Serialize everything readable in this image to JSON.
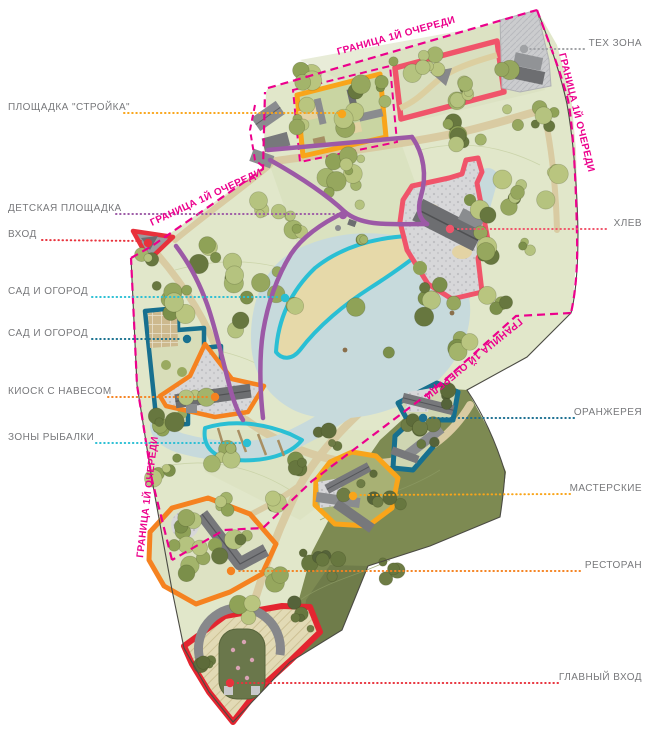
{
  "plan": {
    "boundary_label": "ГРАНИЦА 1Й ОЧЕРЕДИ",
    "left_labels": [
      {
        "text": "ПЛОЩАДКА \"СТРОЙКА\"",
        "color": "#F9A51A"
      },
      {
        "text": "ДЕТСКАЯ ПЛОЩАДКА",
        "color": "#9C59A6"
      },
      {
        "text": "ВХОД",
        "color": "#E8323C"
      },
      {
        "text": "САД И ОГОРОД",
        "color": "#2ABFD4"
      },
      {
        "text": "САД И ОГОРОД",
        "color": "#17708F"
      },
      {
        "text": "КИОСК С НАВЕСОМ",
        "color": "#F58220"
      },
      {
        "text": "ЗОНЫ РЫБАЛКИ",
        "color": "#2ABFD4"
      }
    ],
    "right_labels": [
      {
        "text": "ТЕХ ЗОНА",
        "color": "#A0A2A5"
      },
      {
        "text": "ХЛЕВ",
        "color": "#F0546A"
      },
      {
        "text": "ОРАНЖЕРЕЯ",
        "color": "#1B6F91"
      },
      {
        "text": "МАСТЕРСКИЕ",
        "color": "#F9A51A"
      },
      {
        "text": "РЕСТОРАН",
        "color": "#F58220"
      },
      {
        "text": "ГЛАВНЫЙ ВХОД",
        "color": "#E8323C"
      }
    ],
    "colors": {
      "phase_boundary_magenta": "#EC008C",
      "path_purple": "#9C59A6",
      "water": "#C7DADC",
      "park_green": "#E1E7CA",
      "forest_dark": "#7D8A52",
      "label_text": "#77787B"
    }
  }
}
